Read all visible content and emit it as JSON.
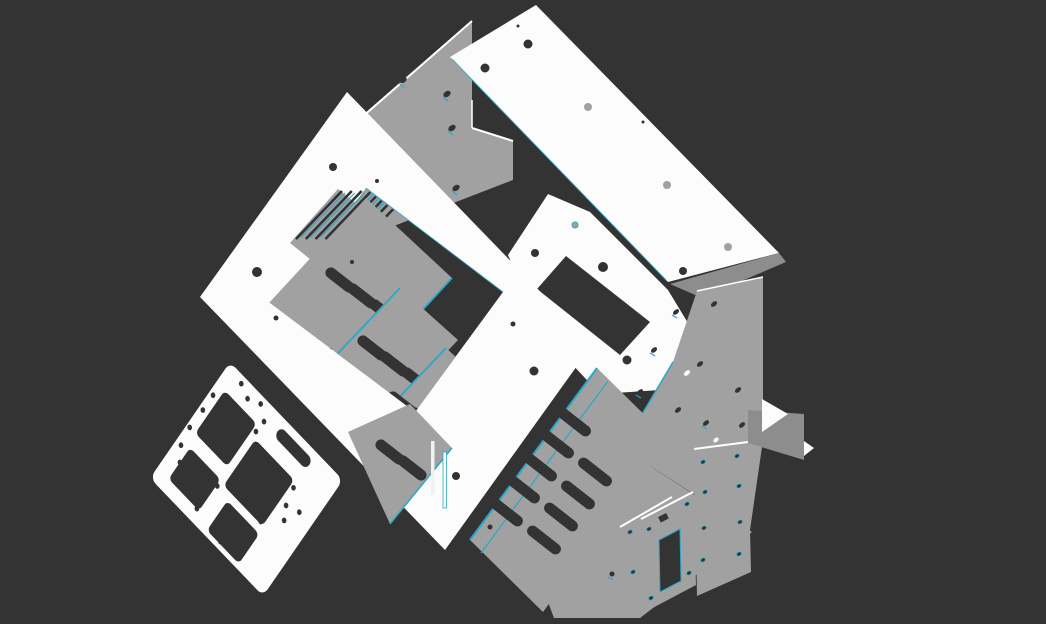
{
  "viewport": {
    "title": "3D CAD sheet-metal enclosure assembly",
    "width": 1046,
    "height": 624,
    "view": "isometric exploded view",
    "background_style": "solid dark gray, no grid, no UI chrome"
  },
  "colors": {
    "background": "#333333",
    "panel-white": "#f1f1f1",
    "panel-bright": "#fcfcfc",
    "panel-gray": "#a1a1a1",
    "panel-gray-dark": "#8d8d8d",
    "hole-dark": "#333333",
    "edge-teal": "#29a8c8",
    "edge-white": "#ffffff"
  },
  "parts": [
    {
      "id": "rear-wall-panel",
      "label": "Rear wall panel with notch and oval holes",
      "color": "gray"
    },
    {
      "id": "top-cover-panel",
      "label": "Top cover panel with screw holes",
      "color": "white"
    },
    {
      "id": "side-cover-panel",
      "label": "Side cover panel with rectangular notch",
      "color": "white"
    },
    {
      "id": "right-side-panel",
      "label": "Right side panel with oval mounting holes",
      "color": "gray"
    },
    {
      "id": "chassis-floor",
      "label": "Chassis floor wedge",
      "color": "gray"
    },
    {
      "id": "front-bezel-frame",
      "label": "Front bezel frame with window cutout",
      "color": "white"
    },
    {
      "id": "vent-plate-stack",
      "label": "Internal vented plate stack with slots",
      "color": "gray"
    },
    {
      "id": "lower-vent-bank",
      "label": "Lower vented plate bank",
      "color": "gray"
    },
    {
      "id": "base-mounting-plate",
      "label": "Base mounting plate with cutouts and holes",
      "color": "white"
    },
    {
      "id": "rear-bracket-plate",
      "label": "Rear bracket plate with hole pattern",
      "color": "gray"
    },
    {
      "id": "small-bracket-plate",
      "label": "Small square bracket plate",
      "color": "gray"
    },
    {
      "id": "connector-bracket",
      "label": "Connector bracket with rectangular cutout",
      "color": "gray"
    },
    {
      "id": "side-flange",
      "label": "Right side flange",
      "color": "gray"
    }
  ]
}
